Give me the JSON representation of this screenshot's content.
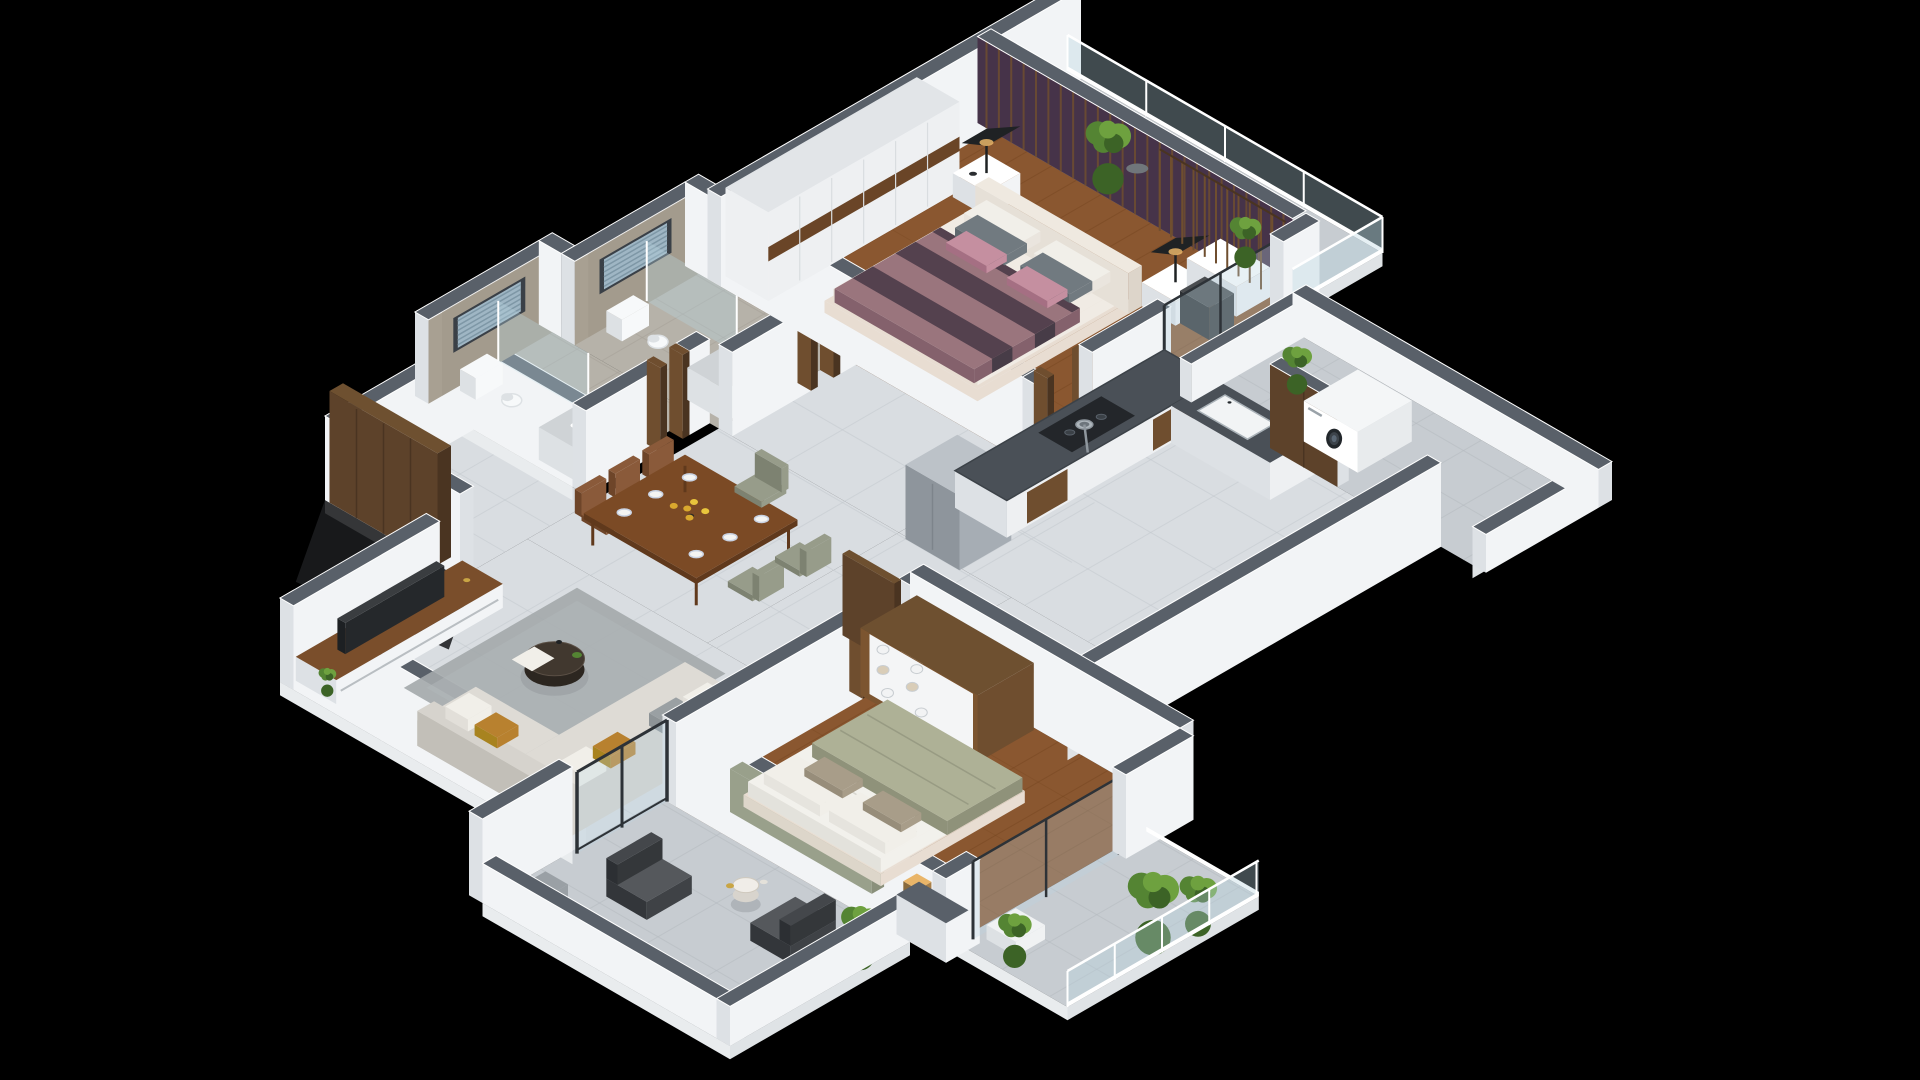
{
  "meta": {
    "view": "isometric-3d-floor-plan-render",
    "background": "#000000",
    "canvas": {
      "width": 1920,
      "height": 1080
    }
  },
  "palette": {
    "bg": "#000000",
    "wallFace": "#f2f4f6",
    "wallShade": "#dde1e5",
    "wallTop": "#596069",
    "slab": "#e9ecee",
    "slabSide": "#dfe3e6",
    "tile": "#d9dde1",
    "tileLine": "#c3c9cd",
    "balconyTile": "#c7ccd1",
    "balconyLine": "#b4bac0",
    "bathFloor": "#b6b2a9",
    "bathLine": "#a5a198",
    "wood": "#8a5730",
    "woodDark": "#73451f",
    "woodLight": "#9a6538",
    "marble": "#a8a092",
    "marbleDark": "#948c7e",
    "windowFrame": "#3a4047",
    "blind": "#9fb6c4",
    "blindDark": "#7e97a6",
    "accentWall": "#463349",
    "slatWood": "#6f4e2f",
    "wardrobeFace": "#eef0f2",
    "wardrobeBand": "#6a4527",
    "tvScreen": "#25282b",
    "tvUnitTop": "#7a4e2b",
    "sofa": "#d6d3cd",
    "sofaShade": "#c2bfb8",
    "cushionMustard": "#b8812f",
    "cushionGray": "#9aa0a3",
    "cushionWhite": "#f1efe9",
    "rug": "#a3a8ab",
    "rugLight": "#b2b7b9",
    "coffeeTop": "#41382f",
    "coffeeSide": "#2c2620",
    "tableTop": "#7b4a25",
    "tableSide": "#60391c",
    "chairBrown": "#8a5a3a",
    "chairBrownDark": "#6e4529",
    "chairSage": "#979c8a",
    "chairSageDark": "#7d8271",
    "granite": "#4a5057",
    "graniteEdge": "#3c4248",
    "cabinet": "#eef0f2",
    "fridge": "#a6adb4",
    "fridgeShade": "#8e959c",
    "fridgeTop": "#bcc2c8",
    "steel": "#aeb6bc",
    "burner": "#23262a",
    "mattress": "#f0ebe4",
    "bedBase": "#e8ddd2",
    "mauve": "#9a757d",
    "mauveDark": "#54414e",
    "mauveSide": "#84616c",
    "pillowGray": "#717a80",
    "pillowPink": "#c58fa0",
    "sage": "#aeb196",
    "sageDark": "#8f927a",
    "headboardSage": "#99a08b",
    "duvet": "#f2f1ec",
    "pillowTaupe": "#a89d89",
    "white": "#ffffff",
    "porcelain": "#f7f9fa",
    "porcelainShade": "#dde1e4",
    "basinTop": "#cfd3d6",
    "glass": "#b8d4e0",
    "glassFrame": "#2d3237",
    "plantDark": "#3c6326",
    "plant": "#548433",
    "plantLight": "#6ea13f",
    "pot": "#9aa0a5",
    "potDark": "#70767b",
    "planter": "#f0f2f3",
    "lampBlack": "#1f2224",
    "lampWarm": "#e9b569",
    "doorWood": "#5d422a",
    "doorWoodDark": "#4a3421",
    "doorWoodTop": "#6e5030",
    "shadow": "#1b1d1f",
    "gold": "#c9a544"
  },
  "scene": {
    "type": "apartment-2bhk-isometric-cutaway",
    "rooms": [
      {
        "name": "entrance-foyer",
        "floor": "tile",
        "items": [
          "entrance-door-panel"
        ]
      },
      {
        "name": "living-room",
        "floor": "tile",
        "items": [
          "tv-unit",
          "television",
          "l-shaped-sofa",
          "area-rug",
          "round-coffee-table",
          "throw-pillows"
        ]
      },
      {
        "name": "dining-area",
        "floor": "tile",
        "items": [
          "dining-table",
          "dining-chairs",
          "plates",
          "yellow-flower-centerpiece"
        ]
      },
      {
        "name": "bathroom-1",
        "floor": "stone",
        "items": [
          "toilet",
          "washbasin",
          "window-with-blinds",
          "glass-shower-partition"
        ]
      },
      {
        "name": "bathroom-2",
        "floor": "stone",
        "items": [
          "toilet",
          "washbasin",
          "window-with-blinds",
          "glass-shower-partition"
        ]
      },
      {
        "name": "master-bedroom",
        "floor": "wood",
        "items": [
          "wardrobe",
          "double-bed-mauve",
          "nightstands",
          "table-lamps",
          "accent-slat-wall",
          "desk",
          "chair",
          "wood-slat-screen"
        ]
      },
      {
        "name": "master-balcony",
        "floor": "tile",
        "items": [
          "potted-plants",
          "glass-railing"
        ]
      },
      {
        "name": "kitchen",
        "floor": "tile",
        "items": [
          "refrigerator",
          "granite-counter",
          "gas-hob",
          "cooking-pan",
          "sink-unit",
          "wooden-door"
        ]
      },
      {
        "name": "bedroom-2",
        "floor": "wood",
        "items": [
          "double-bed-sage",
          "open-shelf-unit",
          "towels",
          "baskets",
          "floor-lamp",
          "glass-partition"
        ]
      },
      {
        "name": "bedroom-balcony",
        "floor": "tile",
        "items": [
          "potted-plants",
          "planter-box",
          "glass-railing"
        ]
      },
      {
        "name": "living-balcony",
        "floor": "tile",
        "items": [
          "lounge-chairs",
          "round-side-table",
          "potted-plants",
          "sliding-glass-door"
        ]
      },
      {
        "name": "utility-balcony",
        "floor": "tile",
        "items": [
          "washing-machine"
        ]
      }
    ]
  }
}
